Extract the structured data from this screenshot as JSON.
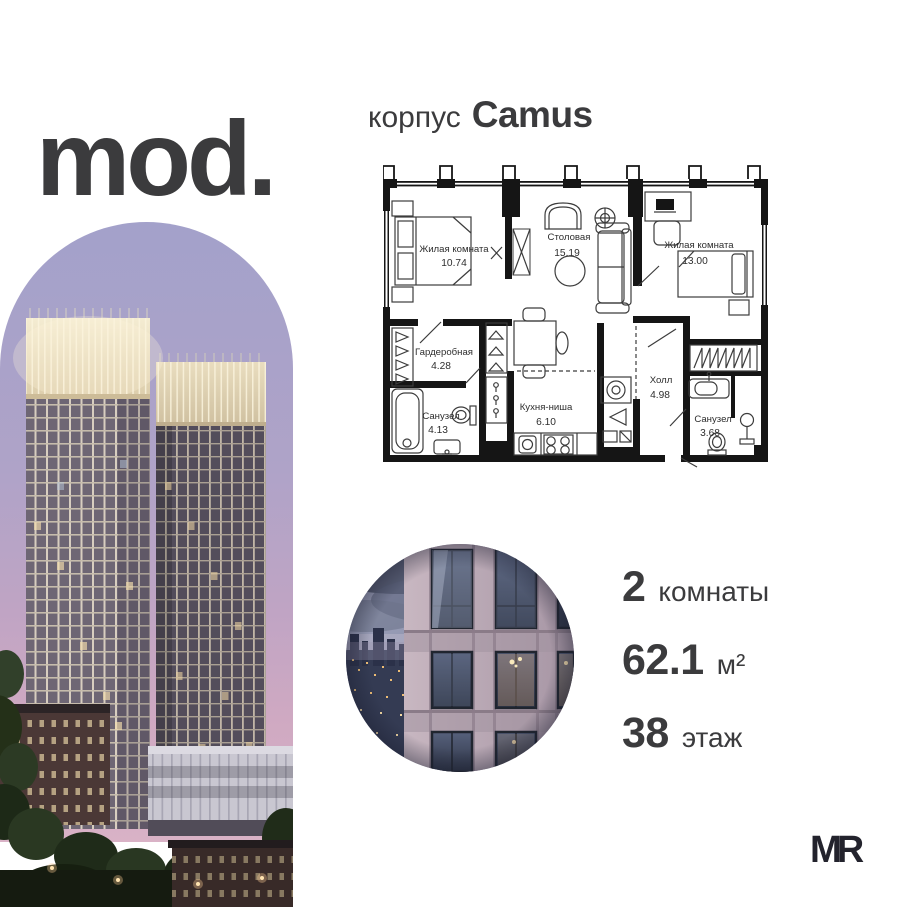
{
  "brand": {
    "logo_text": "mod."
  },
  "header": {
    "prefix": "корпус",
    "building_name": "Camus"
  },
  "floor_plan": {
    "rooms": [
      {
        "name": "Жилая комната",
        "area": "10.74"
      },
      {
        "name": "Столовая",
        "area": "15.19"
      },
      {
        "name": "Жилая комната",
        "area": "13.00"
      },
      {
        "name": "Гардеробная",
        "area": "4.28"
      },
      {
        "name": "Санузел",
        "area": "4.13"
      },
      {
        "name": "Кухня-ниша",
        "area": "6.10"
      },
      {
        "name": "Холл",
        "area": "4.98"
      },
      {
        "name": "Санузел",
        "area": "3.68"
      }
    ]
  },
  "stats": {
    "rooms": {
      "value": "2",
      "label": "комнаты"
    },
    "area": {
      "value": "62.1",
      "label": "м²"
    },
    "floor": {
      "value": "38",
      "label": "этаж"
    }
  },
  "footer": {
    "developer_logo": "MR"
  },
  "colors": {
    "text": "#3b3b3d",
    "plan_wall": "#151515",
    "sky_top": "#a3a1ca",
    "sky_bottom": "#d9b2c6",
    "crown_light": "#f2ead0"
  }
}
